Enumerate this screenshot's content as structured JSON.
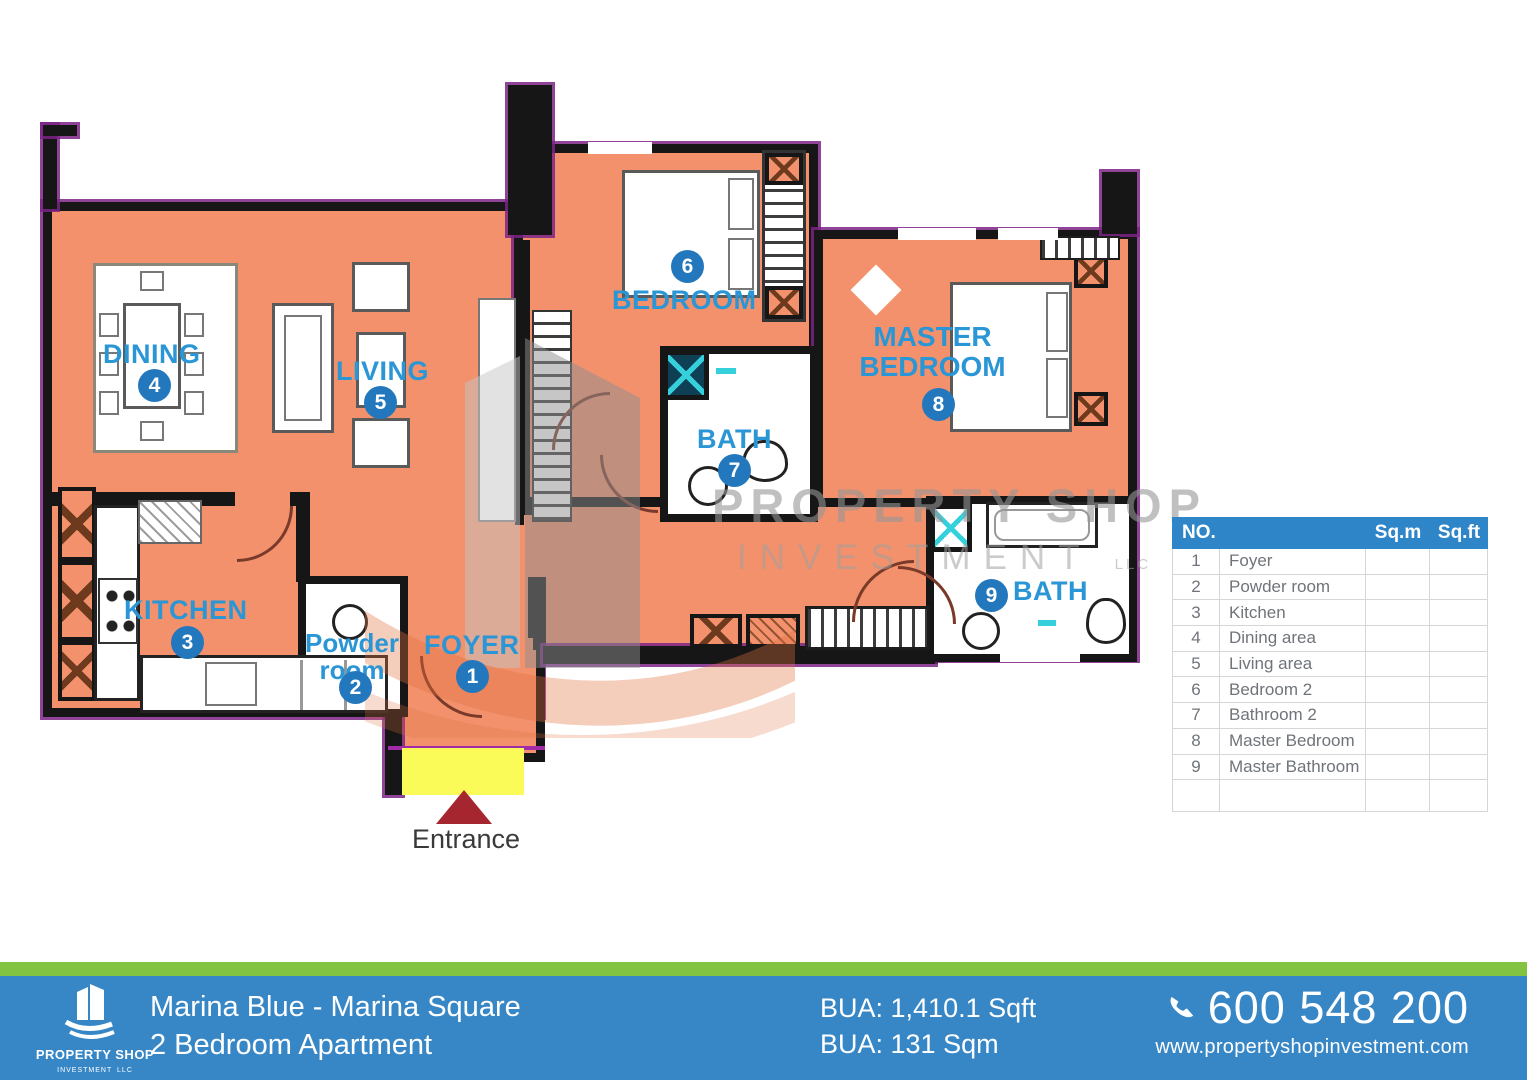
{
  "plan": {
    "labels": {
      "dining": {
        "text": "DINING",
        "num": "4"
      },
      "living": {
        "text": "LIVING",
        "num": "5"
      },
      "kitchen": {
        "text": "KITCHEN",
        "num": "3"
      },
      "powder": {
        "line1": "Powder",
        "line2": "room",
        "num": "2"
      },
      "foyer": {
        "text": "FOYER",
        "num": "1"
      },
      "bedroom2": {
        "text": "BEDROOM",
        "num": "6"
      },
      "bath2": {
        "text": "BATH",
        "num": "7"
      },
      "master": {
        "line1": "MASTER",
        "line2": "BEDROOM",
        "num": "8"
      },
      "masterbath": {
        "text": "BATH",
        "num": "9"
      }
    },
    "entrance_label": "Entrance"
  },
  "watermark": {
    "line1": "PROPERTY SHOP",
    "line2": "INVESTMENT",
    "suffix": "LLC"
  },
  "table": {
    "header": {
      "no": "NO.",
      "name": "",
      "sqm": "Sq.m",
      "sqft": "Sq.ft"
    },
    "rows": [
      {
        "no": "1",
        "name": "Foyer",
        "sqm": "",
        "sqft": ""
      },
      {
        "no": "2",
        "name": "Powder room",
        "sqm": "",
        "sqft": ""
      },
      {
        "no": "3",
        "name": "Kitchen",
        "sqm": "",
        "sqft": ""
      },
      {
        "no": "4",
        "name": "Dining area",
        "sqm": "",
        "sqft": ""
      },
      {
        "no": "5",
        "name": "Living area",
        "sqm": "",
        "sqft": ""
      },
      {
        "no": "6",
        "name": "Bedroom 2",
        "sqm": "",
        "sqft": ""
      },
      {
        "no": "7",
        "name": "Bathroom 2",
        "sqm": "",
        "sqft": ""
      },
      {
        "no": "8",
        "name": "Master Bedroom",
        "sqm": "",
        "sqft": ""
      },
      {
        "no": "9",
        "name": "Master Bathroom",
        "sqm": "",
        "sqft": ""
      },
      {
        "no": "",
        "name": "",
        "sqm": "",
        "sqft": ""
      }
    ]
  },
  "footer": {
    "logo": {
      "name": "PROPERTY SHOP",
      "sub": "INVESTMENT",
      "suffix": "LLC"
    },
    "project": "Marina Blue - Marina Square",
    "unit": "2 Bedroom Apartment",
    "bua_sqft": "BUA: 1,410.1 Sqft",
    "bua_sqm": "BUA: 131 Sqm",
    "phone": "600 548 200",
    "website": "www.propertyshopinvestment.com"
  },
  "colors": {
    "floor_orange": "#F2916B",
    "wall_black": "#161616",
    "trim_purple": "#7B2386",
    "label_blue": "#2B96D6",
    "badge_blue": "#2277BD",
    "entrance_yellow": "#FAFA58",
    "arrow_red": "#A5262E",
    "footer_blue": "#3787C7",
    "footer_green": "#82C341",
    "table_header_blue": "#2E86C8"
  }
}
